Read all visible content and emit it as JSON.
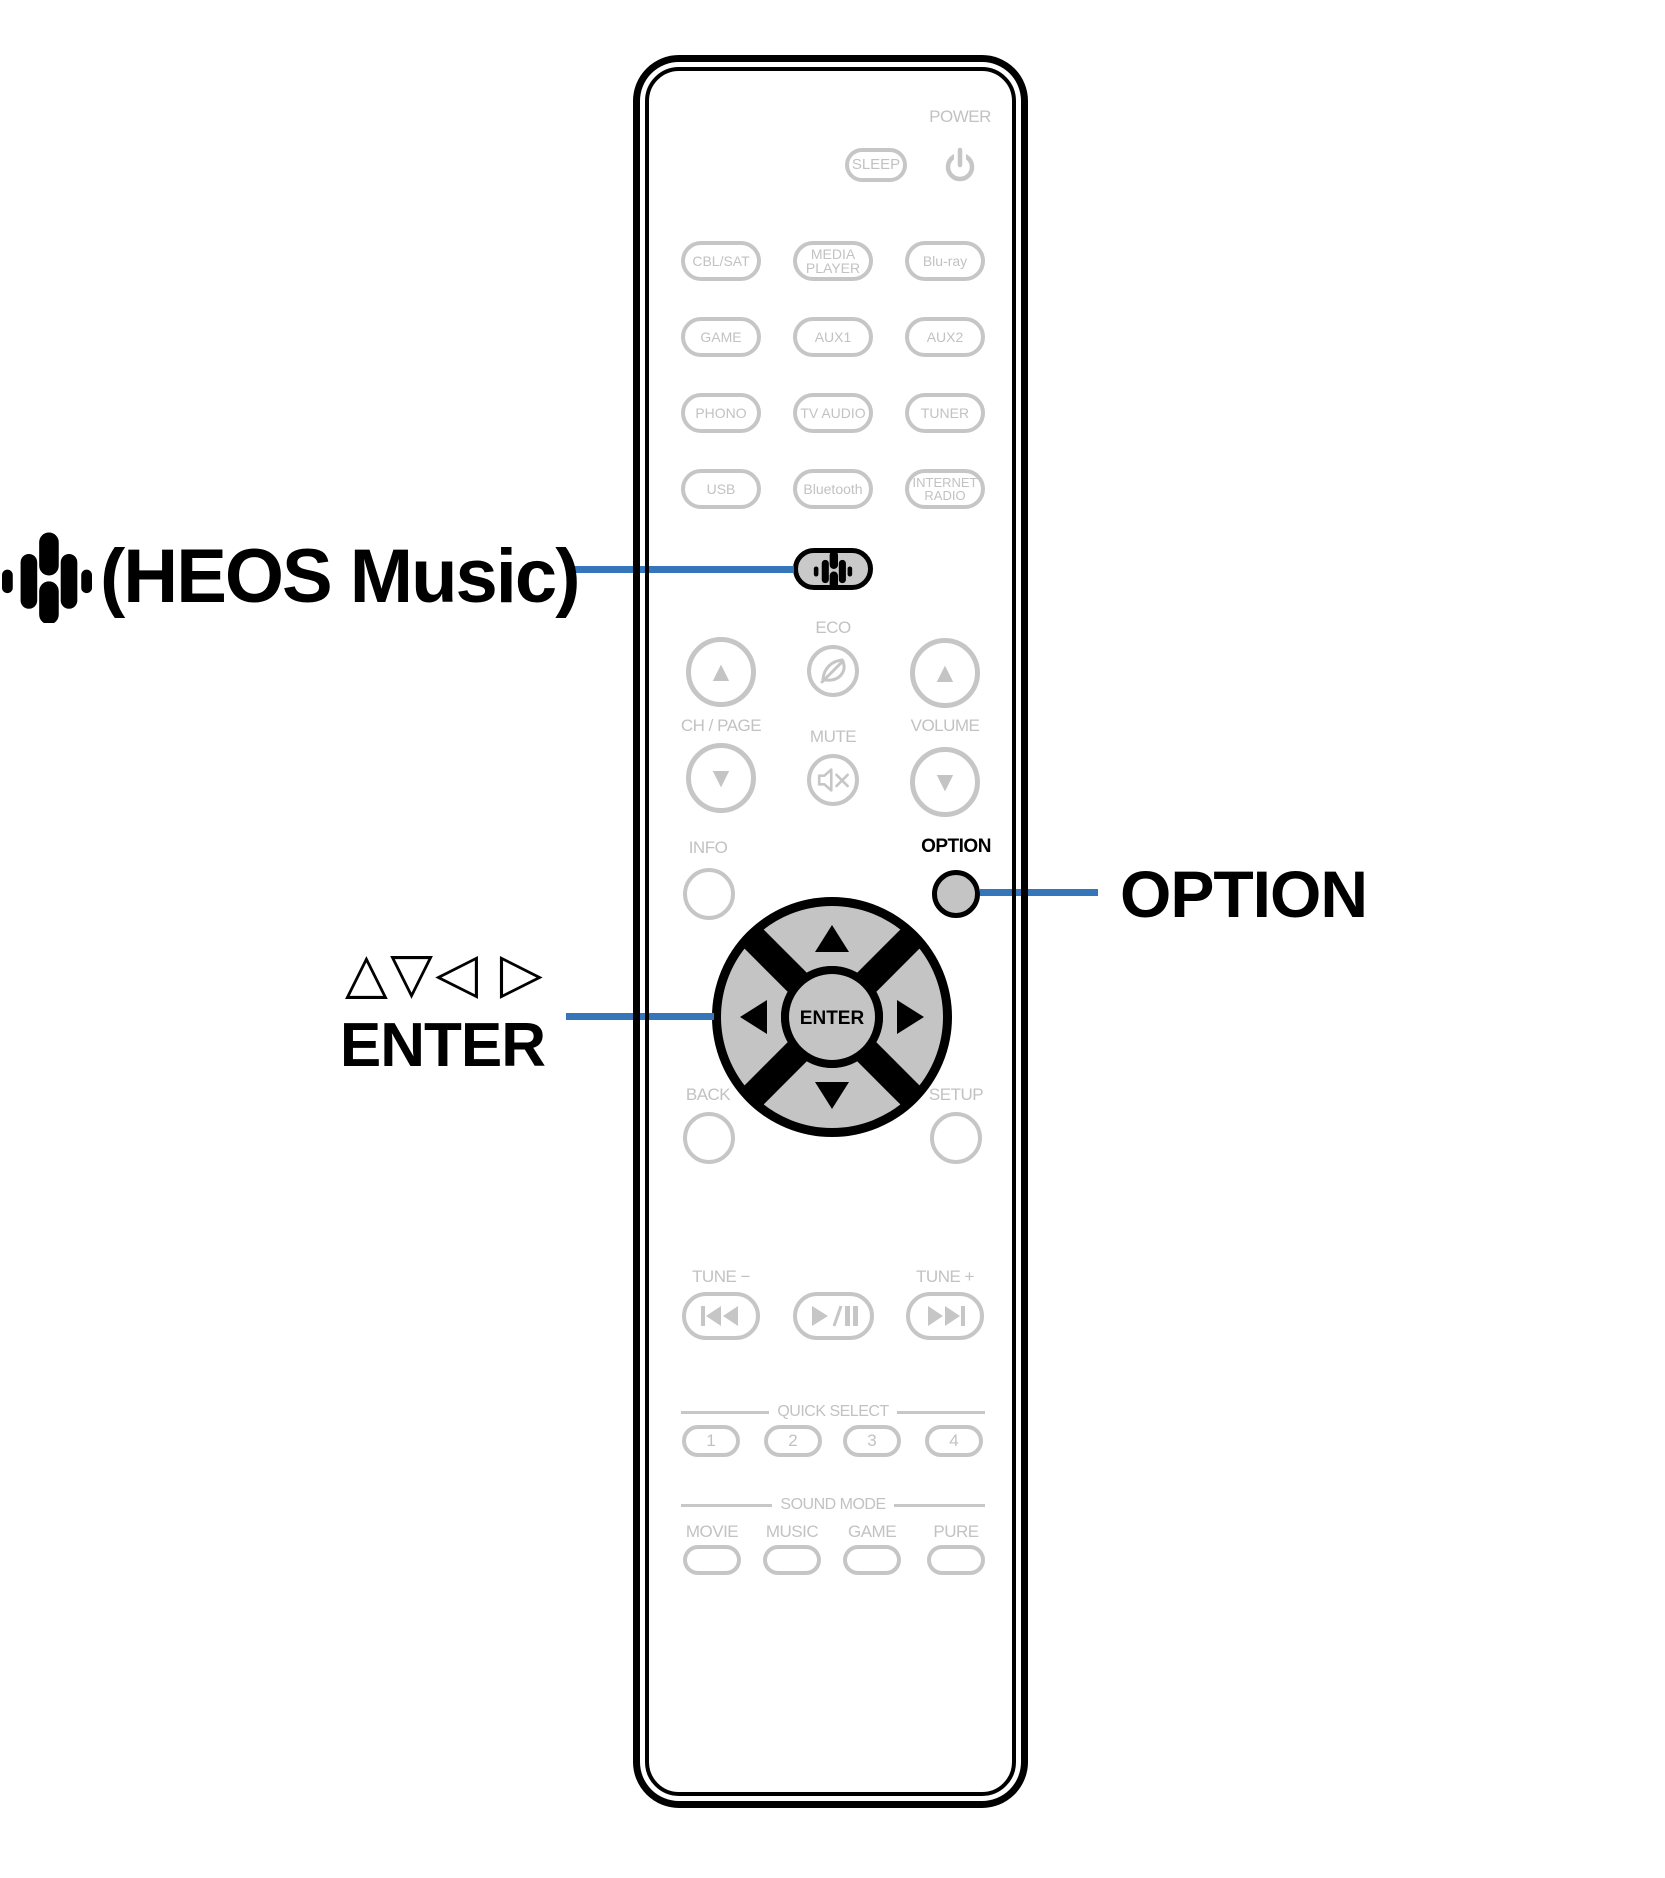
{
  "callouts": {
    "heos_label": "(HEOS Music)",
    "cursor_symbols": "△▽◁ ▷",
    "cursor_label": "ENTER",
    "option_label": "OPTION"
  },
  "remote": {
    "power_label": "POWER",
    "sleep_label": "SLEEP",
    "sources": [
      "CBL/SAT",
      "MEDIA PLAYER",
      "Blu-ray",
      "GAME",
      "AUX1",
      "AUX2",
      "PHONO",
      "TV AUDIO",
      "TUNER",
      "USB",
      "Bluetooth",
      "INTERNET RADIO"
    ],
    "eco_label": "ECO",
    "ch_page_label": "CH / PAGE",
    "mute_label": "MUTE",
    "volume_label": "VOLUME",
    "info_label": "INFO",
    "option_label": "OPTION",
    "back_label": "BACK",
    "setup_label": "SETUP",
    "enter_label": "ENTER",
    "tune_down_label": "TUNE −",
    "tune_up_label": "TUNE +",
    "quick_select_title": "QUICK SELECT",
    "quick_select_buttons": [
      "1",
      "2",
      "3",
      "4"
    ],
    "sound_mode_title": "SOUND MODE",
    "sound_mode_labels": [
      "MOVIE",
      "MUSIC",
      "GAME",
      "PURE"
    ]
  },
  "colors": {
    "accent_blue": "#3575B9",
    "inactive_gray": "#C6C6C6",
    "highlight_fill": "#C9C9C9",
    "black": "#000000"
  }
}
